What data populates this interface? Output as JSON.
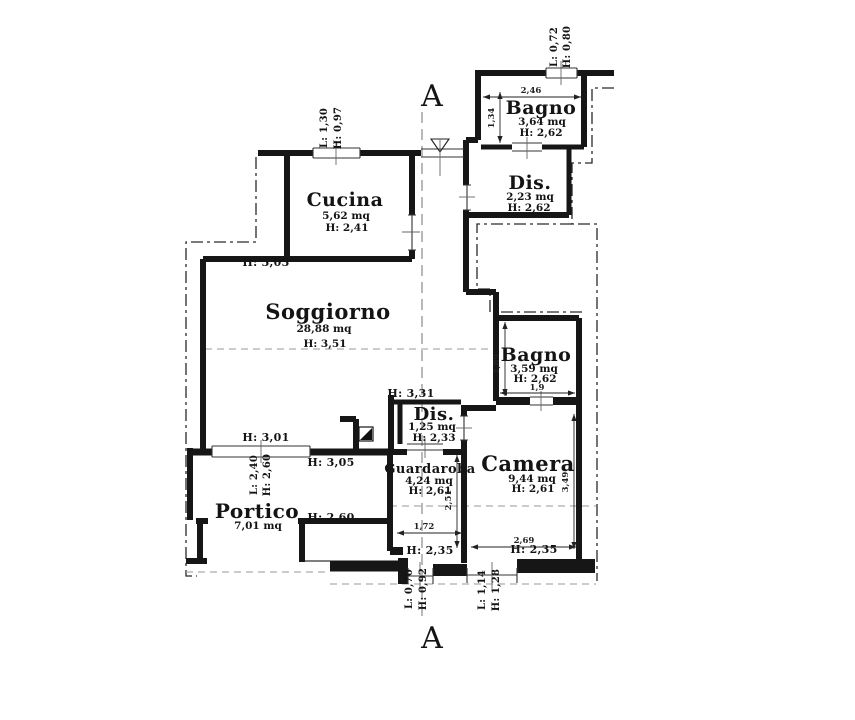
{
  "drawing": {
    "type": "floor-plan",
    "section": {
      "label": "A"
    },
    "rooms": {
      "cucina": {
        "name": "Cucina",
        "area": "5,62 mq",
        "height": "H: 2,41"
      },
      "soggiorno": {
        "name": "Soggiorno",
        "area": "28,88 mq",
        "height": "H: 3,51"
      },
      "bagno_top": {
        "name": "Bagno",
        "area": "3,64 mq",
        "height": "H: 2,62"
      },
      "dis_top": {
        "name": "Dis.",
        "area": "2,23 mq",
        "height": "H: 2,62"
      },
      "bagno_right": {
        "name": "Bagno",
        "area": "3,59 mq",
        "height": "H: 2,62"
      },
      "dis_small": {
        "name": "Dis.",
        "area": "1,25 mq",
        "height": "H: 2,33"
      },
      "camera": {
        "name": "Camera",
        "area": "9,44 mq",
        "height": "H: 2,61"
      },
      "guardaroba": {
        "name": "Guardaroba",
        "area": "4,24 mq",
        "height": "H: 2,61"
      },
      "portico": {
        "name": "Portico",
        "area": "7,01 mq"
      }
    },
    "wall_heights": {
      "soggiorno_top": "H: 3,03",
      "soggiorno_bottom": "H: 3,01",
      "portico_top": "H: 3,05",
      "portico_right": "H: 2,60",
      "dis_small_top": "H: 3,31",
      "guardaroba_bottom": "H: 2,35",
      "camera_bottom": "H: 2,35"
    },
    "openings": {
      "cucina_window": {
        "l": "L: 1,30",
        "h": "H: 0,97"
      },
      "bagno_top_window": {
        "l": "L: 0,72",
        "h": "H: 0,80"
      },
      "portico_window": {
        "l": "L: 2,40",
        "h": "H: 2,60"
      },
      "south_door_small": {
        "l": "L: 0,70",
        "h": "H: 0,92"
      },
      "south_door_large": {
        "l": "L: 1,14",
        "h": "H: 1,28"
      }
    },
    "dimensions": {
      "bagno_top_width": "2,46",
      "bagno_top_depth": "1,34",
      "bagno_right_depth": "1,89",
      "bagno_right_width": "1,9",
      "camera_depth": "3,49",
      "camera_width": "2,69",
      "guardaroba_depth": "2,51",
      "guardaroba_width": "1,72"
    }
  }
}
